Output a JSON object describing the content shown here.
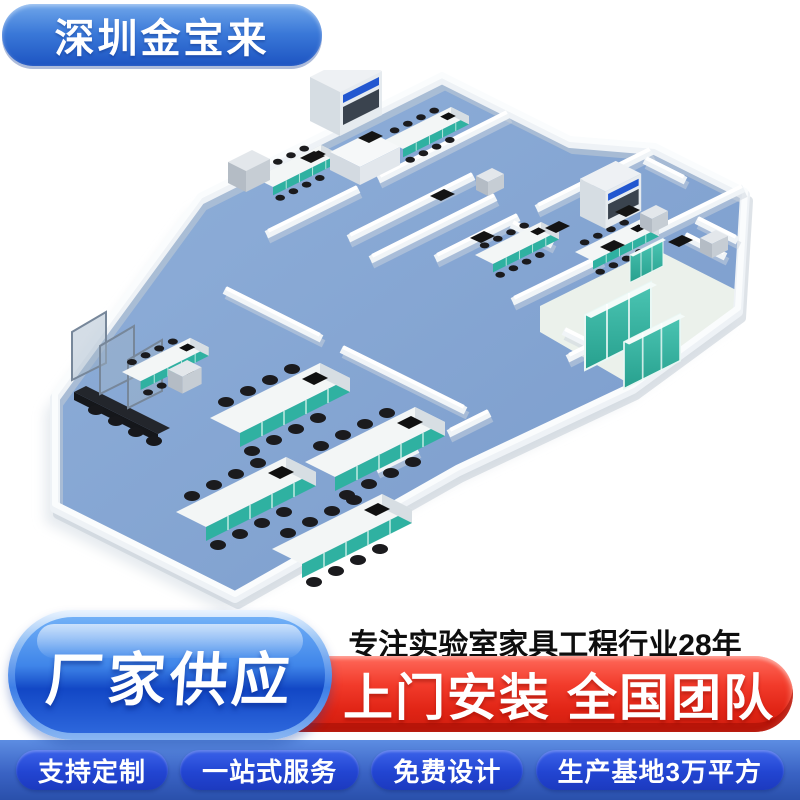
{
  "brand_banner": {
    "label": "深圳金宝来"
  },
  "headline": {
    "text": "专注实验室家具工程行业28年"
  },
  "supply_button": {
    "label": "厂家供应"
  },
  "service_banner": {
    "text": "上门安装 全国团队"
  },
  "feature_pills": {
    "items": [
      {
        "label": "支持定制"
      },
      {
        "label": "一站式服务"
      },
      {
        "label": "免费设计"
      },
      {
        "label": "生产基地3万平方"
      }
    ]
  },
  "illustration": {
    "name": "isometric-lab-floorplan-render",
    "elements": [
      "blue-epoxy-floor",
      "white-partition-walls",
      "lab-island-benches",
      "teal-base-cabinets",
      "office-chairs",
      "fume-hoods",
      "teal-glass-partitions",
      "control-desk-with-glass-dividers",
      "equipment-boxes",
      "annex-cubicles"
    ],
    "colors": {
      "floor_blue": "#84a4d2",
      "wall_white": "#f0f4f7",
      "bench_top": "#f3f6f6",
      "bench_cabinet_teal": "#2fb1a1",
      "annex_floor": "#ebf1eb",
      "accent_stripe_blue": "#2257d0"
    }
  },
  "colors": {
    "brand_blue_light": "#6fa6ea",
    "brand_blue_dark": "#1d54c2",
    "button_blue_light": "#71b0f7",
    "button_blue_dark": "#1247c5",
    "banner_red": "#ee372b",
    "banner_red_dark": "#c51808",
    "strip_blue_top": "#5d8de2",
    "strip_blue_bottom": "#2a50ab",
    "pill_blue": "#2245d2",
    "headline_text": "#0e0e0e",
    "text_white": "#ffffff"
  }
}
